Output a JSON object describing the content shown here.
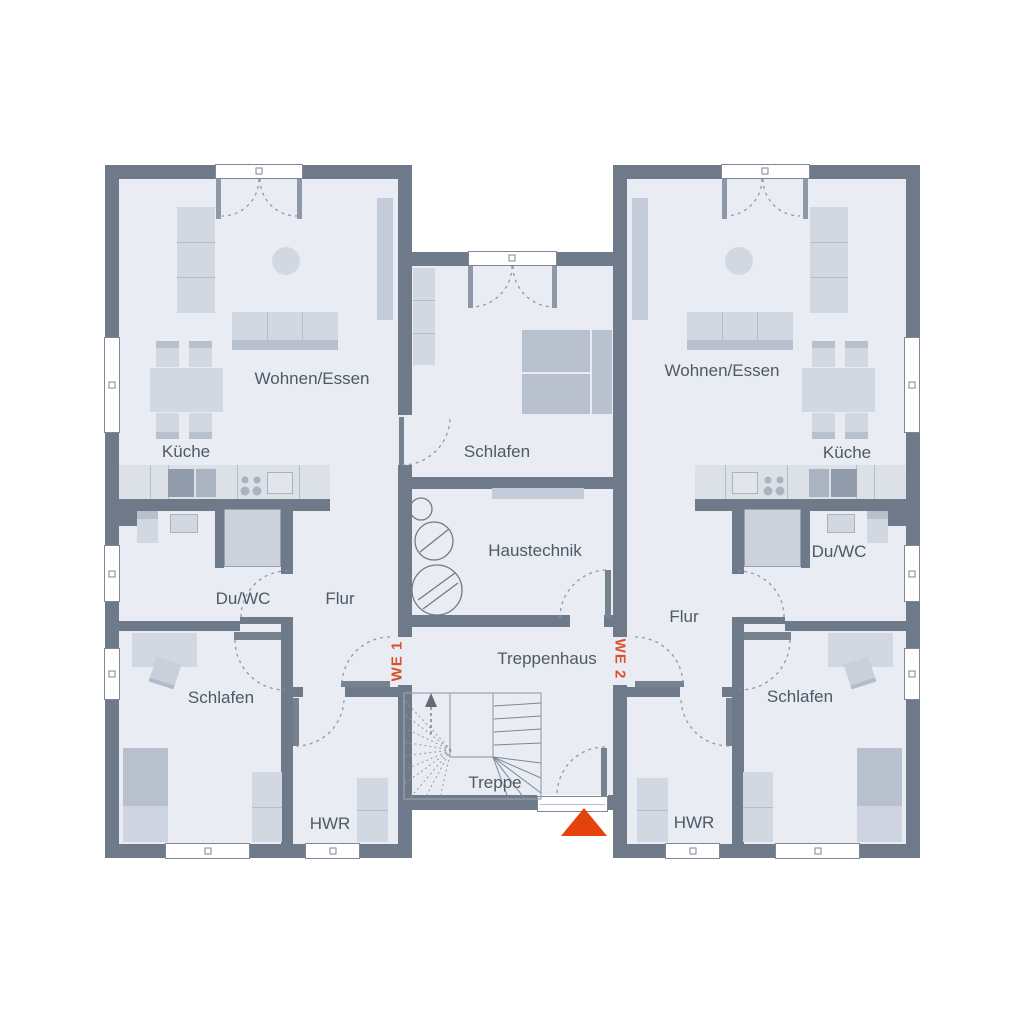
{
  "units": {
    "we1": "WE 1",
    "we2": "WE 2"
  },
  "rooms": {
    "we1_wohnen": "Wohnen/Essen",
    "we1_kueche": "Küche",
    "we1_duwc": "Du/WC",
    "we1_flur": "Flur",
    "we1_schlafen": "Schlafen",
    "we1_hwr": "HWR",
    "mid_schlafen": "Schlafen",
    "haustechnik": "Haustechnik",
    "treppenhaus": "Treppenhaus",
    "treppe": "Treppe",
    "we2_wohnen": "Wohnen/Essen",
    "we2_kueche": "Küche",
    "we2_duwc": "Du/WC",
    "we2_flur": "Flur",
    "we2_schlafen": "Schlafen",
    "we2_hwr": "HWR"
  },
  "colors": {
    "wall": "#6e7a8a",
    "floor": "#e9edf3",
    "furniture_light": "#d2d8e1",
    "furniture_dark": "#b8c0cd",
    "tag_accent": "#d9512b",
    "entrance_marker": "#e5430e",
    "label_text": "#4e5966"
  },
  "icons": {
    "entrance_marker": "entrance-triangle",
    "stairs_arrow": "up-arrow"
  }
}
